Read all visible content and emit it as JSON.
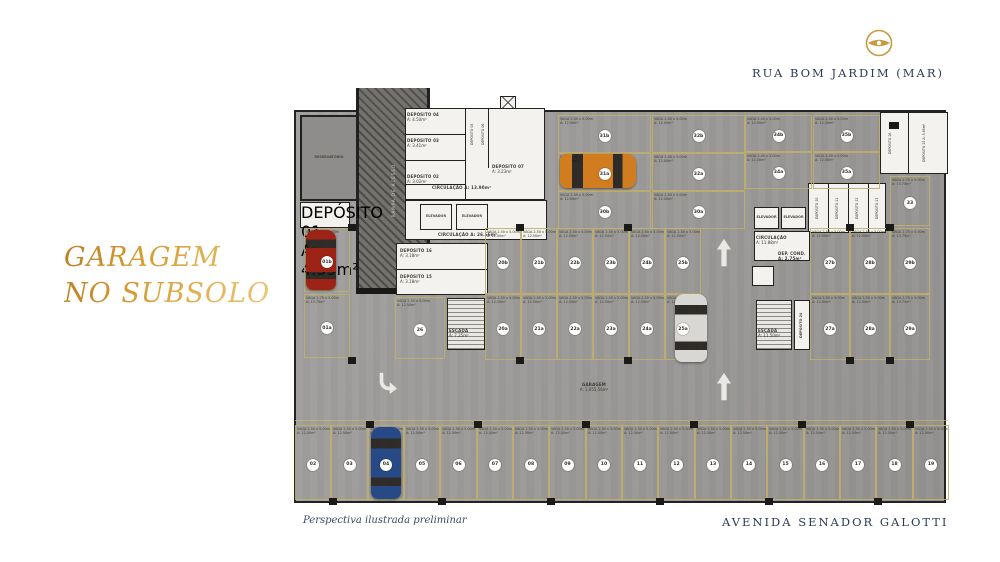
{
  "title": {
    "line1": "GARAGEM",
    "line2": "NO SUBSOLO",
    "color": "#cf9b3a"
  },
  "streets": {
    "top": "RUA BOM JARDIM (MAR)",
    "bottom": "AVENIDA SENADOR GALOTTI",
    "color": "#2b3a55"
  },
  "caption": "Perspectiva ilustrada preliminar",
  "logo": {
    "name": "brand-logo",
    "color": "#c99a3d"
  },
  "plan": {
    "center_label": {
      "l1": "GARAGEM",
      "l2": "A: 1.055,56m²"
    },
    "colors": {
      "slab": "#9c9b99",
      "room": "#f3f2ef",
      "wall": "#21211f",
      "spot_line": "#c1ae6a"
    },
    "spot_sizes": {
      "v": [
        "VAGA 2.50 x 5.00m",
        "A: 12.50m²"
      ],
      "w": [
        "VAGA 2.75 x 5.00m",
        "A: 13.75m²"
      ],
      "h": [
        "VAGA 2.40 x 5.00m",
        "A: 12.00m²"
      ]
    },
    "spots": [
      {
        "n": "02",
        "x": 3,
        "y": 337,
        "w": 36,
        "h": 75,
        "s": "v"
      },
      {
        "n": "03",
        "x": 39,
        "y": 337,
        "w": 37,
        "h": 75,
        "s": "v"
      },
      {
        "n": "04",
        "x": 76,
        "y": 337,
        "w": 36,
        "h": 75,
        "s": "v"
      },
      {
        "n": "05",
        "x": 112,
        "y": 337,
        "w": 36,
        "h": 75,
        "s": "v"
      },
      {
        "n": "06",
        "x": 148,
        "y": 337,
        "w": 37,
        "h": 75,
        "s": "v"
      },
      {
        "n": "07",
        "x": 185,
        "y": 337,
        "w": 36,
        "h": 75,
        "s": "v"
      },
      {
        "n": "08",
        "x": 221,
        "y": 337,
        "w": 36,
        "h": 75,
        "s": "v"
      },
      {
        "n": "09",
        "x": 257,
        "y": 337,
        "w": 37,
        "h": 75,
        "s": "v"
      },
      {
        "n": "10",
        "x": 294,
        "y": 337,
        "w": 36,
        "h": 75,
        "s": "v"
      },
      {
        "n": "11",
        "x": 330,
        "y": 337,
        "w": 36,
        "h": 75,
        "s": "v"
      },
      {
        "n": "12",
        "x": 366,
        "y": 337,
        "w": 37,
        "h": 75,
        "s": "v"
      },
      {
        "n": "13",
        "x": 403,
        "y": 337,
        "w": 36,
        "h": 75,
        "s": "v"
      },
      {
        "n": "14",
        "x": 439,
        "y": 337,
        "w": 36,
        "h": 75,
        "s": "v"
      },
      {
        "n": "15",
        "x": 475,
        "y": 337,
        "w": 37,
        "h": 75,
        "s": "v"
      },
      {
        "n": "16",
        "x": 512,
        "y": 337,
        "w": 36,
        "h": 75,
        "s": "v"
      },
      {
        "n": "17",
        "x": 548,
        "y": 337,
        "w": 36,
        "h": 75,
        "s": "v"
      },
      {
        "n": "18",
        "x": 584,
        "y": 337,
        "w": 37,
        "h": 75,
        "s": "v"
      },
      {
        "n": "19",
        "x": 621,
        "y": 337,
        "w": 36,
        "h": 75,
        "s": "v"
      },
      {
        "n": "01b",
        "x": 12,
        "y": 140,
        "w": 46,
        "h": 64,
        "s": "w"
      },
      {
        "n": "01a",
        "x": 12,
        "y": 206,
        "w": 46,
        "h": 64,
        "s": "w"
      },
      {
        "n": "20b",
        "x": 193,
        "y": 140,
        "w": 36,
        "h": 66,
        "s": "v"
      },
      {
        "n": "21b",
        "x": 229,
        "y": 140,
        "w": 36,
        "h": 66,
        "s": "v"
      },
      {
        "n": "22b",
        "x": 265,
        "y": 140,
        "w": 36,
        "h": 66,
        "s": "v"
      },
      {
        "n": "23b",
        "x": 301,
        "y": 140,
        "w": 36,
        "h": 66,
        "s": "v"
      },
      {
        "n": "24b",
        "x": 337,
        "y": 140,
        "w": 36,
        "h": 66,
        "s": "v"
      },
      {
        "n": "25b",
        "x": 373,
        "y": 140,
        "w": 36,
        "h": 66,
        "s": "v"
      },
      {
        "n": "20a",
        "x": 193,
        "y": 206,
        "w": 36,
        "h": 66,
        "s": "v"
      },
      {
        "n": "21a",
        "x": 229,
        "y": 206,
        "w": 36,
        "h": 66,
        "s": "v"
      },
      {
        "n": "22a",
        "x": 265,
        "y": 206,
        "w": 36,
        "h": 66,
        "s": "v"
      },
      {
        "n": "23a",
        "x": 301,
        "y": 206,
        "w": 36,
        "h": 66,
        "s": "v"
      },
      {
        "n": "24a",
        "x": 337,
        "y": 206,
        "w": 36,
        "h": 66,
        "s": "v"
      },
      {
        "n": "25a",
        "x": 373,
        "y": 206,
        "w": 36,
        "h": 66,
        "s": "v"
      },
      {
        "n": "26",
        "x": 103,
        "y": 209,
        "w": 50,
        "h": 62,
        "s": "v"
      },
      {
        "n": "27b",
        "x": 518,
        "y": 140,
        "w": 40,
        "h": 66,
        "s": "v"
      },
      {
        "n": "28b",
        "x": 558,
        "y": 140,
        "w": 40,
        "h": 66,
        "s": "v"
      },
      {
        "n": "29b",
        "x": 598,
        "y": 140,
        "w": 40,
        "h": 66,
        "s": "w"
      },
      {
        "n": "27a",
        "x": 518,
        "y": 206,
        "w": 40,
        "h": 66,
        "s": "v"
      },
      {
        "n": "28a",
        "x": 558,
        "y": 206,
        "w": 40,
        "h": 66,
        "s": "v"
      },
      {
        "n": "29a",
        "x": 598,
        "y": 206,
        "w": 40,
        "h": 66,
        "s": "w"
      },
      {
        "n": "33",
        "x": 598,
        "y": 88,
        "w": 40,
        "h": 50,
        "s": "w"
      },
      {
        "n": "31b",
        "x": 266,
        "y": 27,
        "w": 93,
        "h": 38,
        "s": "h"
      },
      {
        "n": "32b",
        "x": 360,
        "y": 27,
        "w": 93,
        "h": 38,
        "s": "h"
      },
      {
        "n": "31a",
        "x": 266,
        "y": 65,
        "w": 93,
        "h": 38,
        "s": "h"
      },
      {
        "n": "32a",
        "x": 360,
        "y": 65,
        "w": 93,
        "h": 38,
        "s": "h"
      },
      {
        "n": "30b",
        "x": 266,
        "y": 103,
        "w": 93,
        "h": 38,
        "s": "h"
      },
      {
        "n": "30a",
        "x": 360,
        "y": 103,
        "w": 93,
        "h": 38,
        "s": "h"
      },
      {
        "n": "34b",
        "x": 453,
        "y": 27,
        "w": 67,
        "h": 37,
        "s": "h"
      },
      {
        "n": "35b",
        "x": 521,
        "y": 27,
        "w": 67,
        "h": 37,
        "s": "h"
      },
      {
        "n": "34a",
        "x": 453,
        "y": 64,
        "w": 67,
        "h": 37,
        "s": "h"
      },
      {
        "n": "35a",
        "x": 521,
        "y": 64,
        "w": 67,
        "h": 37,
        "s": "h"
      }
    ],
    "rooms": [
      {
        "id": "ramp",
        "t": "ramp",
        "x": 64,
        "y": 0,
        "w": 74,
        "h": 206,
        "lines": [
          "RAMPA DE ACESSO"
        ],
        "vert": true
      },
      {
        "id": "ramp-cap",
        "t": "cap",
        "x": 64,
        "y": 200,
        "w": 74,
        "h": 6
      },
      {
        "id": "reservatorio",
        "t": "dark",
        "x": 8,
        "y": 27,
        "w": 58,
        "h": 86,
        "lines": [
          "RESERVATÓRIO"
        ]
      },
      {
        "id": "dep-01",
        "t": "white",
        "x": 8,
        "y": 114,
        "w": 50,
        "h": 26,
        "lines": [
          "DEPÓSITO 01",
          "A: 4.59m²"
        ]
      },
      {
        "id": "cluster-left",
        "t": "white",
        "x": 113,
        "y": 20,
        "w": 140,
        "h": 92
      },
      {
        "id": "wall-a",
        "t": "wall",
        "x": 173,
        "y": 20,
        "w": 1,
        "h": 92
      },
      {
        "id": "wall-b",
        "t": "wall",
        "x": 196,
        "y": 20,
        "w": 1,
        "h": 60
      },
      {
        "id": "wall-c",
        "t": "wall",
        "x": 113,
        "y": 46,
        "w": 60,
        "h": 1
      },
      {
        "id": "wall-d",
        "t": "wall",
        "x": 113,
        "y": 72,
        "w": 60,
        "h": 1
      },
      {
        "id": "wall-e",
        "t": "wall",
        "x": 113,
        "y": 96,
        "w": 60,
        "h": 1
      },
      {
        "id": "dep-04",
        "t": "text",
        "x": 115,
        "y": 24,
        "w": 56,
        "h": 20,
        "lines": [
          "DEPÓSITO 04",
          "A: 4.50m²"
        ]
      },
      {
        "id": "dep-03",
        "t": "text",
        "x": 115,
        "y": 50,
        "w": 56,
        "h": 20,
        "lines": [
          "DEPÓSITO 03",
          "A: 3.41m²"
        ]
      },
      {
        "id": "dep-02",
        "t": "text",
        "x": 115,
        "y": 86,
        "w": 56,
        "h": 20,
        "lines": [
          "DEPÓSITO 02",
          "A: 3.02m²"
        ]
      },
      {
        "id": "dep-05",
        "t": "text",
        "x": 175,
        "y": 22,
        "w": 10,
        "h": 48,
        "lines": [
          "DEPÓSITO 05"
        ],
        "vert": true
      },
      {
        "id": "dep-06",
        "t": "text",
        "x": 186,
        "y": 22,
        "w": 10,
        "h": 48,
        "lines": [
          "DEPÓSITO 06"
        ],
        "vert": true
      },
      {
        "id": "dep-07",
        "t": "text",
        "x": 200,
        "y": 76,
        "w": 52,
        "h": 20,
        "lines": [
          "DEPÓSITO 07",
          "A: 3.23m²"
        ]
      },
      {
        "id": "circ-1",
        "t": "text",
        "x": 140,
        "y": 97,
        "w": 80,
        "h": 12,
        "lines": [
          "CIRCULAÇÃO A: 13.90m²"
        ]
      },
      {
        "id": "circ-strip",
        "t": "white",
        "x": 113,
        "y": 112,
        "w": 142,
        "h": 40
      },
      {
        "id": "elev-l1",
        "t": "cell",
        "x": 128,
        "y": 116,
        "w": 32,
        "h": 26,
        "lines": [
          "ELEVADOR"
        ]
      },
      {
        "id": "elev-l2",
        "t": "cell",
        "x": 164,
        "y": 116,
        "w": 32,
        "h": 26,
        "lines": [
          "ELEVADOR"
        ]
      },
      {
        "id": "circ-2",
        "t": "text",
        "x": 146,
        "y": 144,
        "w": 80,
        "h": 10,
        "lines": [
          "CIRCULAÇÃO A: 26.66m²"
        ]
      },
      {
        "id": "rooms-l2",
        "t": "white",
        "x": 104,
        "y": 155,
        "w": 92,
        "h": 52
      },
      {
        "id": "wall-f",
        "t": "wall",
        "x": 104,
        "y": 181,
        "w": 92,
        "h": 1
      },
      {
        "id": "dep-16",
        "t": "text",
        "x": 108,
        "y": 160,
        "w": 80,
        "h": 18,
        "lines": [
          "DEPÓSITO 16",
          "A: 3.18m²"
        ]
      },
      {
        "id": "dep-15",
        "t": "text",
        "x": 108,
        "y": 186,
        "w": 80,
        "h": 18,
        "lines": [
          "DEPÓSITO 15",
          "A: 3.18m²"
        ]
      },
      {
        "id": "stair-1",
        "t": "stair",
        "x": 155,
        "y": 210,
        "w": 38,
        "h": 52
      },
      {
        "id": "stair-1-label",
        "t": "text",
        "x": 157,
        "y": 240,
        "w": 36,
        "h": 18,
        "lines": [
          "ESCADA",
          "A: 7.25m²"
        ]
      },
      {
        "id": "dep-strip-right",
        "t": "white",
        "x": 516,
        "y": 95,
        "w": 78,
        "h": 50
      },
      {
        "id": "wall-g",
        "t": "wall",
        "x": 536,
        "y": 95,
        "w": 1,
        "h": 50
      },
      {
        "id": "wall-h",
        "t": "wall",
        "x": 556,
        "y": 95,
        "w": 1,
        "h": 50
      },
      {
        "id": "wall-i",
        "t": "wall",
        "x": 576,
        "y": 95,
        "w": 1,
        "h": 50
      },
      {
        "id": "dep-20",
        "t": "text",
        "x": 519,
        "y": 97,
        "w": 12,
        "h": 46,
        "lines": [
          "DEPÓSITO 20"
        ],
        "vert": true
      },
      {
        "id": "dep-21",
        "t": "text",
        "x": 539,
        "y": 97,
        "w": 12,
        "h": 46,
        "lines": [
          "DEPÓSITO 21"
        ],
        "vert": true
      },
      {
        "id": "dep-22",
        "t": "text",
        "x": 559,
        "y": 97,
        "w": 12,
        "h": 46,
        "lines": [
          "DEPÓSITO 22"
        ],
        "vert": true
      },
      {
        "id": "dep-23",
        "t": "text",
        "x": 579,
        "y": 97,
        "w": 12,
        "h": 46,
        "lines": [
          "DEPÓSITO 23"
        ],
        "vert": true
      },
      {
        "id": "elev-r1",
        "t": "cell",
        "x": 462,
        "y": 119,
        "w": 25,
        "h": 22,
        "lines": [
          "ELEVADOR"
        ]
      },
      {
        "id": "elev-r2",
        "t": "cell",
        "x": 489,
        "y": 119,
        "w": 25,
        "h": 22,
        "lines": [
          "ELEVADOR"
        ]
      },
      {
        "id": "circ-room-r",
        "t": "white",
        "x": 462,
        "y": 143,
        "w": 56,
        "h": 30
      },
      {
        "id": "circ-3",
        "t": "text",
        "x": 464,
        "y": 147,
        "w": 52,
        "h": 16,
        "lines": [
          "CIRCULAÇÃO",
          "A: 11.88m²"
        ]
      },
      {
        "id": "dep-cond",
        "t": "text",
        "x": 486,
        "y": 163,
        "w": 32,
        "h": 10,
        "lines": [
          "DEP. COND. A: 2.75m²"
        ]
      },
      {
        "id": "antecamara",
        "t": "cell",
        "x": 460,
        "y": 178,
        "w": 22,
        "h": 20,
        "lines": []
      },
      {
        "id": "stair-2",
        "t": "stair",
        "x": 464,
        "y": 212,
        "w": 36,
        "h": 50
      },
      {
        "id": "stair-2-label",
        "t": "text",
        "x": 466,
        "y": 240,
        "w": 34,
        "h": 18,
        "lines": [
          "ESCADA",
          "A: 11.50m²"
        ]
      },
      {
        "id": "dep-24",
        "t": "cell",
        "x": 502,
        "y": 212,
        "w": 16,
        "h": 50,
        "lines": [
          "DEPÓSITO 24"
        ],
        "vert": true
      },
      {
        "id": "rooms-top-right",
        "t": "white",
        "x": 588,
        "y": 24,
        "w": 68,
        "h": 62
      },
      {
        "id": "wall-j",
        "t": "wall",
        "x": 616,
        "y": 24,
        "w": 1,
        "h": 62
      },
      {
        "id": "dep-26",
        "t": "text",
        "x": 592,
        "y": 28,
        "w": 12,
        "h": 54,
        "lines": [
          "DEPÓSITO 26"
        ],
        "vert": true
      },
      {
        "id": "dep-25",
        "t": "text",
        "x": 626,
        "y": 28,
        "w": 12,
        "h": 54,
        "lines": [
          "DEPÓSITO 25 A: 5.88m²"
        ],
        "vert": true
      },
      {
        "id": "tr-object",
        "t": "cap",
        "x": 597,
        "y": 34,
        "w": 10,
        "h": 7
      },
      {
        "id": "shaft-x",
        "t": "xcell",
        "x": 208,
        "y": 8,
        "w": 16,
        "h": 13
      },
      {
        "id": "strip-line",
        "t": "yline",
        "x": 3,
        "y": 332,
        "w": 653,
        "h": 1
      }
    ],
    "cars": [
      {
        "id": "red-car",
        "color": "#9e2317",
        "x": 14,
        "y": 142,
        "w": 30,
        "h": 60,
        "o": "v"
      },
      {
        "id": "orange-car",
        "color": "#d07c1f",
        "x": 268,
        "y": 66,
        "w": 76,
        "h": 34,
        "o": "h"
      },
      {
        "id": "silver-car",
        "color": "#d8d7d3",
        "x": 383,
        "y": 206,
        "w": 32,
        "h": 68,
        "o": "v"
      },
      {
        "id": "blue-car",
        "color": "#274a86",
        "x": 79,
        "y": 339,
        "w": 30,
        "h": 72,
        "o": "v"
      }
    ],
    "pillars": [
      [
        224,
        136
      ],
      [
        332,
        136
      ],
      [
        224,
        269
      ],
      [
        332,
        269
      ],
      [
        554,
        136
      ],
      [
        554,
        269
      ],
      [
        594,
        136
      ],
      [
        594,
        269
      ],
      [
        56,
        136
      ],
      [
        56,
        269
      ],
      [
        74,
        333
      ],
      [
        182,
        333
      ],
      [
        290,
        333
      ],
      [
        398,
        333
      ],
      [
        506,
        333
      ],
      [
        614,
        333
      ],
      [
        37,
        410
      ],
      [
        146,
        410
      ],
      [
        255,
        410
      ],
      [
        364,
        410
      ],
      [
        473,
        410
      ],
      [
        582,
        410
      ]
    ],
    "arrows": [
      {
        "t": "up",
        "x": 422,
        "y": 150
      },
      {
        "t": "up",
        "x": 422,
        "y": 284
      },
      {
        "t": "curve",
        "x": 84,
        "y": 284
      }
    ]
  }
}
